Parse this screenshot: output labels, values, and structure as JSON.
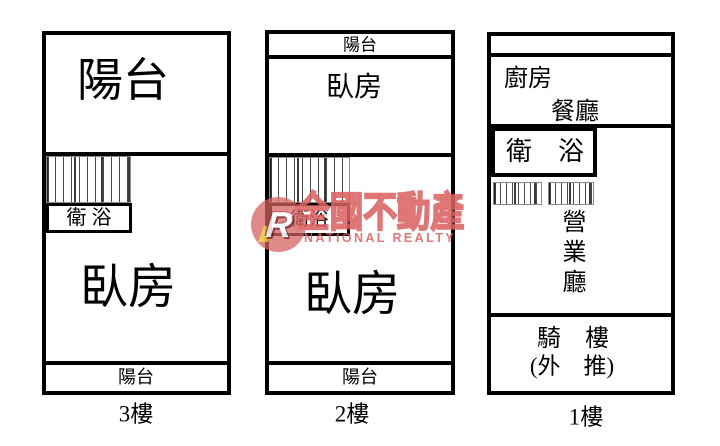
{
  "watermark": {
    "logo_letter": "R",
    "brand": "全國不動產",
    "subtitle": "NATIONAL REALTY",
    "accent_color": "#d95c5c"
  },
  "floors": {
    "f3": {
      "label": "3樓",
      "balcony_top": "陽台",
      "bath": "衛 浴",
      "bedroom": "臥房",
      "balcony_bottom": "陽台"
    },
    "f2": {
      "label": "2樓",
      "balcony_top": "陽台",
      "bedroom_top": "臥房",
      "bath": "衛浴",
      "bedroom": "臥房",
      "balcony_bottom": "陽台"
    },
    "f1": {
      "label": "1樓",
      "kitchen": "廚房",
      "dining": "餐廳",
      "bath": "衛　浴",
      "hall": "營業廳",
      "arcade_line1": "騎　樓",
      "arcade_line2": "(外　推)"
    }
  }
}
